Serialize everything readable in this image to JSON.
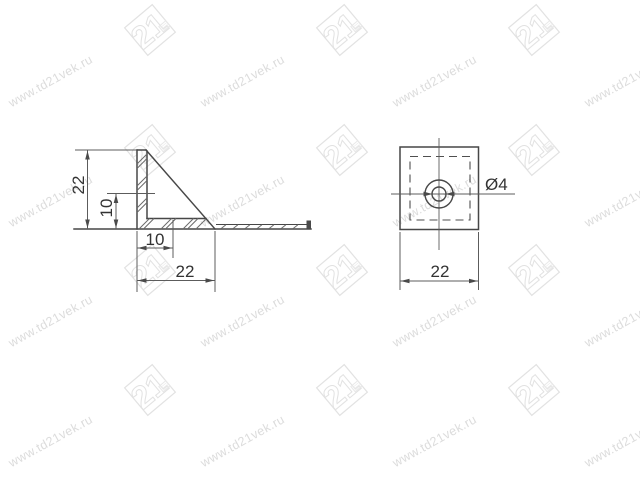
{
  "drawing": {
    "watermark": {
      "url_text": "www.td21vek.ru",
      "logo_text": "21",
      "text_color": "#dcdcdc",
      "logo_color": "#e2e2e2"
    },
    "side_view": {
      "dim_height": "22",
      "dim_hole_center_height": "10",
      "dim_hole_center_offset": "10",
      "dim_width": "22"
    },
    "top_view": {
      "dim_hole_diameter": "Ø4",
      "dim_width": "22"
    },
    "colors": {
      "outline": "#474747",
      "dimension": "#5c5c5c",
      "label": "#333333"
    }
  }
}
